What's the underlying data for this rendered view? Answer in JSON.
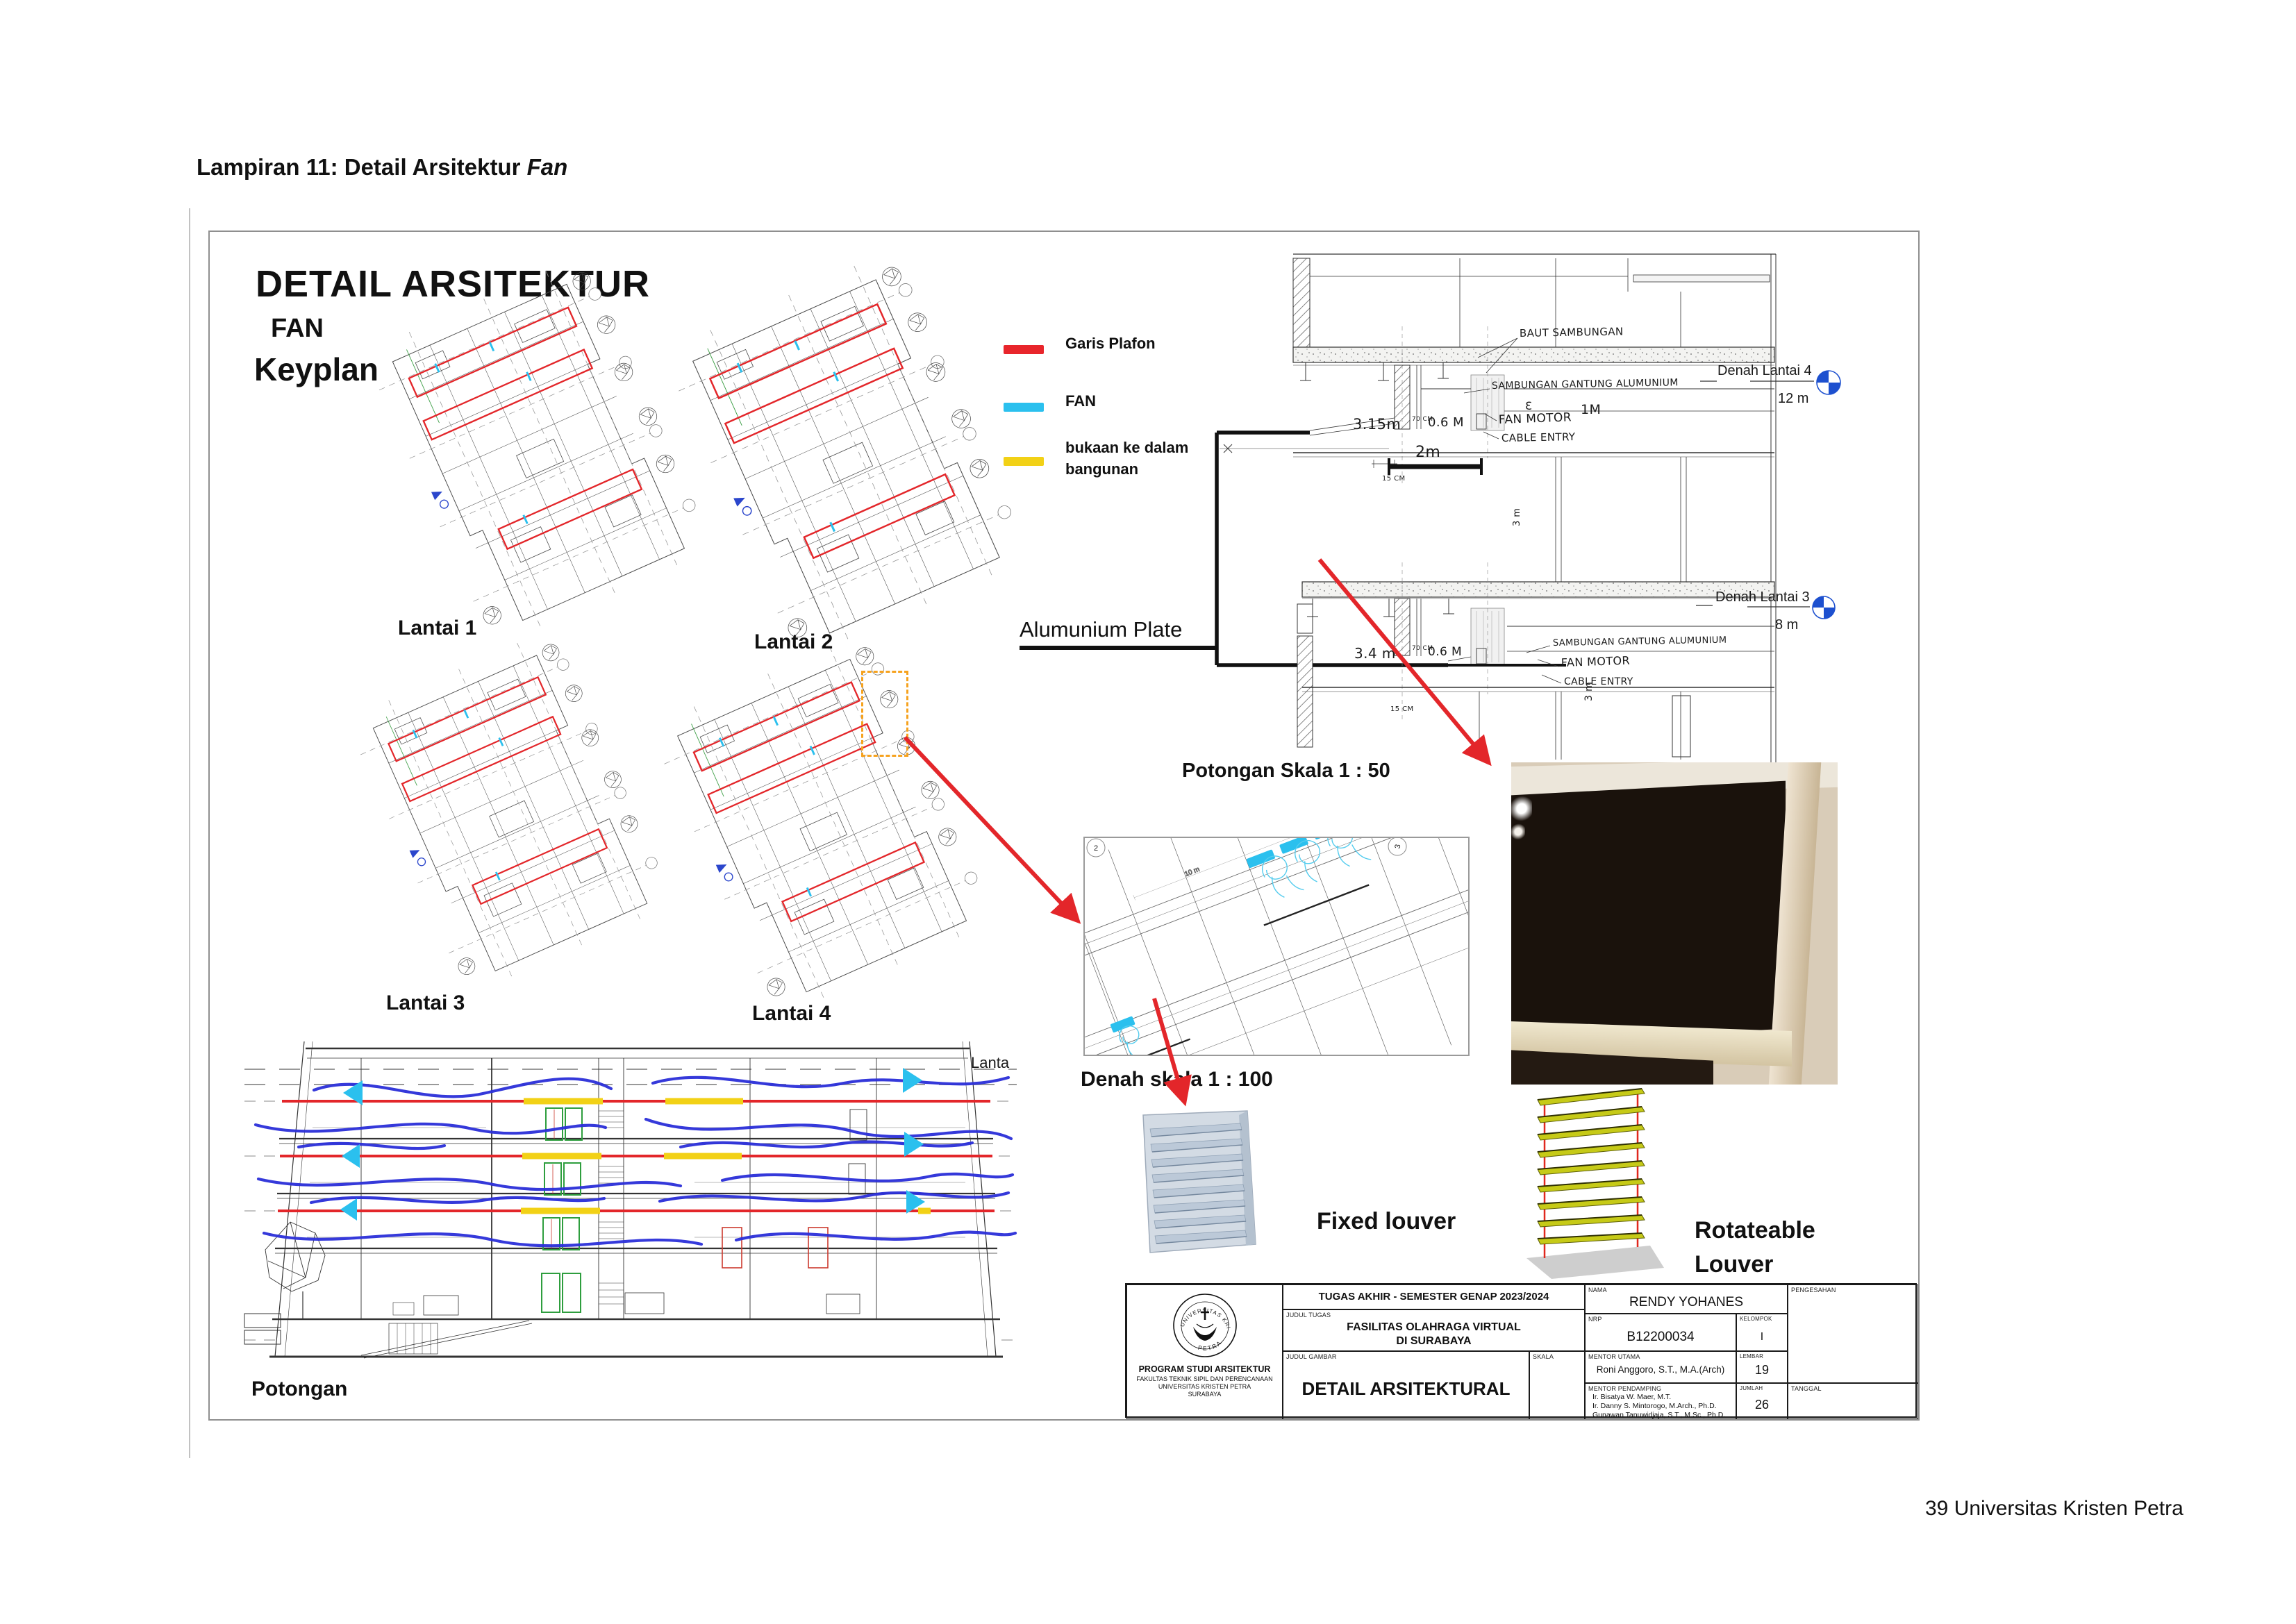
{
  "page": {
    "heading_prefix": "Lampiran 11: Detail Arsitektur ",
    "heading_italic": "Fan",
    "footer": "39 Universitas Kristen Petra"
  },
  "sheet": {
    "title1": "DETAIL ARSITEKTUR",
    "title2": "FAN",
    "title3": "Keyplan",
    "keyplan_labels": [
      "Lantai 1",
      "Lantai 2",
      "Lantai 3",
      "Lantai 4"
    ],
    "legend": {
      "items": [
        {
          "label": "Garis Plafon",
          "color": "#e8252b"
        },
        {
          "label": "FAN",
          "color": "#2bc0ee"
        },
        {
          "label": "bukaan ke dalam bangunan",
          "color": "#f2d116"
        }
      ]
    },
    "section": {
      "caption": "Potongan Skala 1 : 50",
      "callout": "Alumunium Plate",
      "levels": [
        {
          "name": "Denah Lantai 4",
          "elevation": "12 m"
        },
        {
          "name": "Denah Lantai 3",
          "elevation": "8 m"
        }
      ],
      "notes_top": {
        "baut": "BAUT SAMBUNGAN",
        "gantung": "SAMBUNGAN GANTUNG ALUMUNIUM",
        "fan_motor": "FAN MOTOR",
        "fan_dim": "1M",
        "cable": "CABLE ENTRY"
      },
      "notes_bottom": {
        "gantung": "SAMBUNGAN GANTUNG ALUMUNIUM",
        "fan_motor": "FAN MOTOR",
        "cable": "CABLE ENTRY"
      },
      "dims": {
        "h_top": "3.15m",
        "h_bottom": "3.4 m",
        "w70": "70 CM",
        "w06": "0.6 M",
        "w15": "15 CM",
        "bar": "2m",
        "h3": "3 m",
        "e_mark": "Ɛ"
      }
    },
    "denah": {
      "caption": "Denah skala 1 : 100",
      "dim_label": "10 m",
      "bubble_left": "2",
      "bubble_right": "3"
    },
    "potongan": {
      "caption": "Potongan",
      "clipped": "Lanta"
    },
    "louver": {
      "fixed": "Fixed louver",
      "rot1": "Rotateable",
      "rot2": "Louver"
    },
    "titleblock": {
      "header": "TUGAS AKHIR - SEMESTER GENAP 2023/2024",
      "labels": {
        "judul_tugas": "JUDUL TUGAS",
        "judul_gambar": "JUDUL GAMBAR",
        "skala": "SKALA",
        "nama": "NAMA",
        "nrp": "NRP",
        "kelompok": "KELOMPOK",
        "mentor_utama": "MENTOR UTAMA",
        "mentor_pendamping": "MENTOR PENDAMPING",
        "lembar": "LEMBAR",
        "jumlah": "JUMLAH",
        "pengesahan": "PENGESAHAN",
        "tanggal": "TANGGAL"
      },
      "judul_tugas_1": "FASILITAS OLAHRAGA VIRTUAL",
      "judul_tugas_2": "DI SURABAYA",
      "judul_gambar": "DETAIL ARSITEKTURAL",
      "nama": "RENDY YOHANES",
      "nrp": "B12200034",
      "kelompok": "I",
      "mentor_utama": "Roni Anggoro, S.T., M.A.(Arch)",
      "mentors": [
        "Ir. Bisatya W. Maer, M.T.",
        "Ir. Danny S. Mintorogo, M.Arch., Ph.D.",
        "Gunawan Tanuwidjaja, S.T., M.Sc., Ph.D."
      ],
      "lembar": "19",
      "jumlah": "26",
      "institution": [
        "PROGRAM STUDI ARSITEKTUR",
        "FAKULTAS TEKNIK SIPIL DAN PERENCANAAN",
        "UNIVERSITAS KRISTEN PETRA",
        "SURABAYA"
      ],
      "logo_top": "UNIVERSITAS KRISTEN",
      "logo_bottom": "PETRA"
    }
  }
}
